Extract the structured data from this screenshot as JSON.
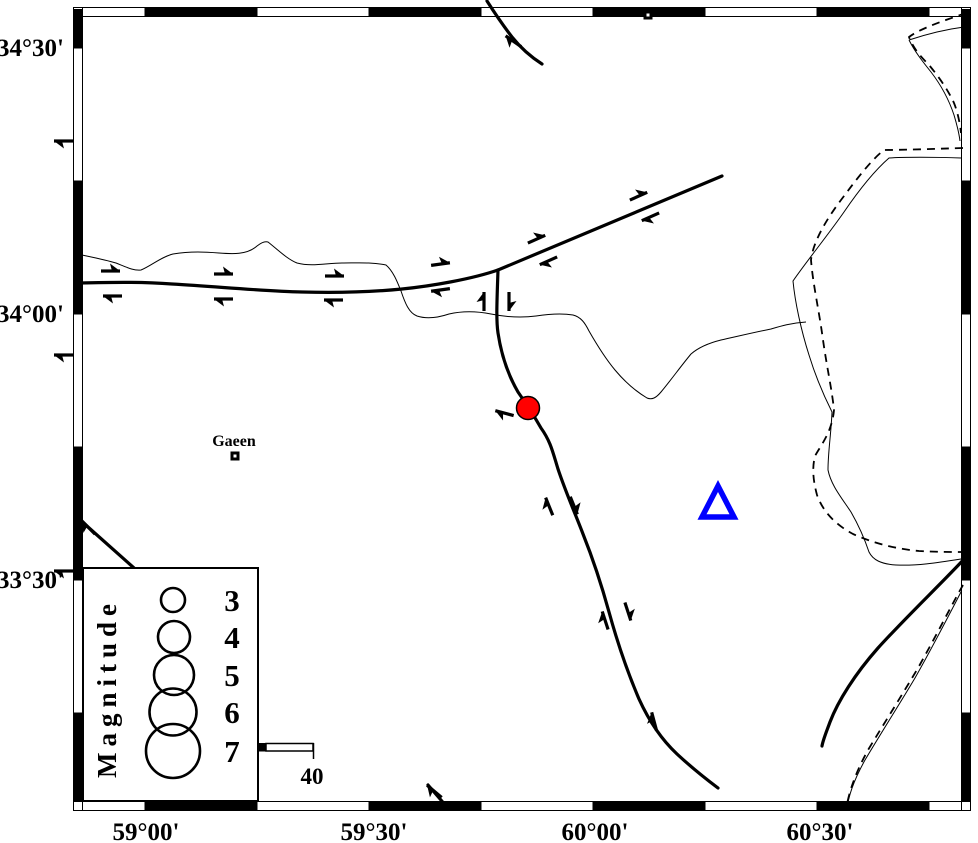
{
  "axes": {
    "lat": [
      "34°30'",
      "34°00'",
      "33°30'"
    ],
    "lon": [
      "59°00'",
      "59°30'",
      "60°00'",
      "60°30'"
    ]
  },
  "places": [
    {
      "name": "Gaeen"
    }
  ],
  "legend": {
    "title": "Magnitude",
    "magnitudes": [
      "3",
      "4",
      "5",
      "6",
      "7"
    ]
  },
  "scale": {
    "label": "40"
  },
  "symbols": {
    "epicenter_color": "#ff0000",
    "station_color": "#0000ff"
  }
}
